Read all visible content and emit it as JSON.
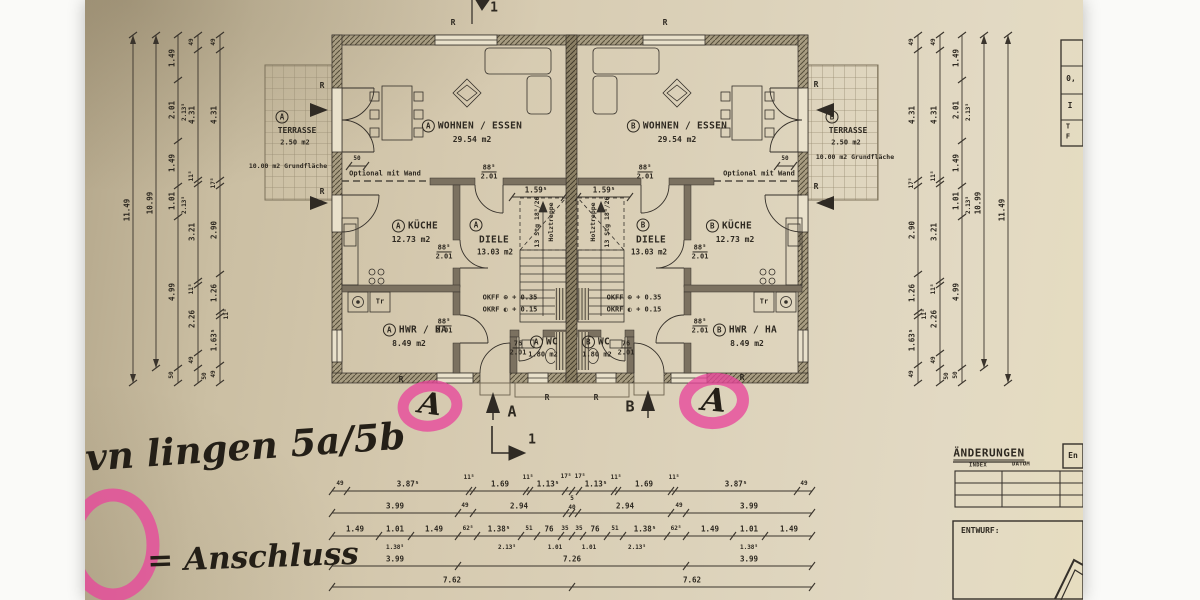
{
  "rooms": {
    "a_living": {
      "unit": "A",
      "name": "WOHNEN / ESSEN",
      "area": "29.54 m2"
    },
    "b_living": {
      "unit": "B",
      "name": "WOHNEN / ESSEN",
      "area": "29.54 m2"
    },
    "a_kitchen": {
      "unit": "A",
      "name": "KÜCHE",
      "area": "12.73 m2"
    },
    "b_kitchen": {
      "unit": "B",
      "name": "KÜCHE",
      "area": "12.73 m2"
    },
    "a_hall": {
      "unit": "A",
      "name": "DIELE",
      "area": "13.03 m2"
    },
    "b_hall": {
      "unit": "B",
      "name": "DIELE",
      "area": "13.03 m2"
    },
    "a_hwr": {
      "unit": "A",
      "name": "HWR / HA",
      "area": "8.49 m2"
    },
    "b_hwr": {
      "unit": "B",
      "name": "HWR / HA",
      "area": "8.49 m2"
    },
    "a_wc": {
      "unit": "A",
      "name": "WC",
      "area": "1.80 m2"
    },
    "b_wc": {
      "unit": "B",
      "name": "WC",
      "area": "1.80 m2"
    }
  },
  "terraces": {
    "a": {
      "unit": "A",
      "name": "TERRASSE",
      "area": "2.50 m2",
      "note": "10.00 m2 Grundfläche"
    },
    "b": {
      "unit": "B",
      "name": "TERRASSE",
      "area": "2.50 m2",
      "note": "10.00 m2 Grundfläche"
    }
  },
  "doors": {
    "w88": "88⁵",
    "w76": "76",
    "h": "2.01"
  },
  "levels": {
    "okff": "OKFF ⊕ + 0.35",
    "okrf": "OKRF ◐ + 0.15"
  },
  "stairs": {
    "dim": "1.59⁵",
    "steps": "13 Stg 18⁵/26",
    "type": "Holztreppe"
  },
  "marks": {
    "r": "R",
    "a": "A",
    "b": "B",
    "section": "1",
    "optional": "Optional mit Wand",
    "fifty": "50"
  },
  "appliances": {
    "tr": "Tr"
  },
  "handwriting": {
    "line1": "ovn lingen 5a/5b",
    "line2": "= Anschluss",
    "mark": "A"
  },
  "title_block": {
    "title": "ÄNDERUNGEN",
    "index": "INDEX",
    "datum": "DATUM",
    "box": "En",
    "entwurf": "ENTWURF:"
  },
  "side_table": {
    "r1": "0,",
    "r2": "I",
    "r3": "T",
    "r4": "F"
  },
  "dims": {
    "vchains": [
      {
        "x": 48,
        "y1": 35,
        "y2": 383,
        "a": 1,
        "ticks": [
          35,
          383
        ],
        "labels": [
          {
            "t": "11.49",
            "y": 210
          }
        ]
      },
      {
        "x": 71,
        "y1": 35,
        "y2": 368,
        "a": 1,
        "ticks": [
          35,
          368
        ],
        "labels": [
          {
            "t": "10.99",
            "y": 203
          }
        ]
      },
      {
        "x": 93,
        "y1": 35,
        "y2": 383,
        "ticks": [
          35,
          80,
          141,
          186,
          217,
          368,
          383
        ],
        "labels": [
          {
            "t": "1.49",
            "y": 58
          },
          {
            "t": "2.01",
            "y": 110
          },
          {
            "t": "2.13⁵",
            "y": 112,
            "dx": 7,
            "s": 1
          },
          {
            "t": "1.49",
            "y": 163
          },
          {
            "t": "1.01",
            "y": 201
          },
          {
            "t": "2.13⁵",
            "y": 205,
            "dx": 7,
            "s": 1
          },
          {
            "t": "4.99",
            "y": 292
          },
          {
            "t": "50",
            "y": 375,
            "s": 1
          }
        ]
      },
      {
        "x": 113,
        "y1": 35,
        "y2": 383,
        "ticks": [
          35,
          50,
          180,
          184,
          281,
          285,
          353,
          368,
          383
        ],
        "labels": [
          {
            "t": "49",
            "y": 42,
            "s": 1
          },
          {
            "t": "4.31",
            "y": 115
          },
          {
            "t": "11⁵",
            "y": 176,
            "s": 1
          },
          {
            "t": "3.21",
            "y": 232
          },
          {
            "t": "11⁵",
            "y": 289,
            "s": 1
          },
          {
            "t": "2.26",
            "y": 319
          },
          {
            "t": "49",
            "y": 360,
            "s": 1
          },
          {
            "t": "50",
            "y": 376,
            "dx": 7,
            "s": 1
          }
        ]
      },
      {
        "x": 135,
        "y1": 35,
        "y2": 383,
        "ticks": [
          35,
          50,
          180,
          186,
          274,
          312,
          316,
          365,
          383
        ],
        "labels": [
          {
            "t": "49",
            "y": 42,
            "s": 1
          },
          {
            "t": "4.31",
            "y": 115
          },
          {
            "t": "17⁵",
            "y": 183,
            "s": 1
          },
          {
            "t": "2.90",
            "y": 230
          },
          {
            "t": "1.26",
            "y": 293
          },
          {
            "t": "11⁵",
            "y": 314,
            "dx": 7,
            "s": 1
          },
          {
            "t": "1.63⁵",
            "y": 340
          },
          {
            "t": "49",
            "y": 374,
            "s": 1
          }
        ]
      },
      {
        "x": 833,
        "y1": 35,
        "y2": 383,
        "ticks": [
          35,
          50,
          180,
          186,
          274,
          312,
          316,
          365,
          383
        ],
        "labels": [
          {
            "t": "49",
            "y": 42,
            "s": 1
          },
          {
            "t": "4.31",
            "y": 115
          },
          {
            "t": "17⁵",
            "y": 183,
            "s": 1
          },
          {
            "t": "2.90",
            "y": 230
          },
          {
            "t": "1.26",
            "y": 293
          },
          {
            "t": "11⁵",
            "y": 314,
            "dx": 7,
            "s": 1
          },
          {
            "t": "1.63⁵",
            "y": 340
          },
          {
            "t": "49",
            "y": 374,
            "s": 1
          }
        ]
      },
      {
        "x": 855,
        "y1": 35,
        "y2": 383,
        "ticks": [
          35,
          50,
          180,
          184,
          281,
          285,
          353,
          368,
          383
        ],
        "labels": [
          {
            "t": "49",
            "y": 42,
            "s": 1
          },
          {
            "t": "4.31",
            "y": 115
          },
          {
            "t": "11⁵",
            "y": 176,
            "s": 1
          },
          {
            "t": "3.21",
            "y": 232
          },
          {
            "t": "11⁵",
            "y": 289,
            "s": 1
          },
          {
            "t": "2.26",
            "y": 319
          },
          {
            "t": "49",
            "y": 360,
            "s": 1
          },
          {
            "t": "50",
            "y": 376,
            "dx": 7,
            "s": 1
          }
        ]
      },
      {
        "x": 877,
        "y1": 35,
        "y2": 383,
        "ticks": [
          35,
          80,
          141,
          186,
          217,
          368,
          383
        ],
        "labels": [
          {
            "t": "1.49",
            "y": 58
          },
          {
            "t": "2.01",
            "y": 110
          },
          {
            "t": "2.13⁵",
            "y": 112,
            "dx": 7,
            "s": 1
          },
          {
            "t": "1.49",
            "y": 163
          },
          {
            "t": "1.01",
            "y": 201
          },
          {
            "t": "2.13⁵",
            "y": 205,
            "dx": 7,
            "s": 1
          },
          {
            "t": "4.99",
            "y": 292
          },
          {
            "t": "50",
            "y": 375,
            "s": 1
          }
        ]
      },
      {
        "x": 899,
        "y1": 35,
        "y2": 368,
        "a": 1,
        "ticks": [
          35,
          368
        ],
        "labels": [
          {
            "t": "10.99",
            "y": 203
          }
        ]
      },
      {
        "x": 923,
        "y1": 35,
        "y2": 383,
        "a": 1,
        "ticks": [
          35,
          383
        ],
        "labels": [
          {
            "t": "11.49",
            "y": 210
          }
        ]
      }
    ],
    "hchains": [
      {
        "y": 491,
        "x1": 247,
        "x2": 727,
        "ticks": [
          247,
          262,
          384,
          388,
          441,
          445,
          480,
          487,
          494,
          529,
          533,
          586,
          590,
          712,
          727
        ],
        "labels": [
          {
            "t": "49",
            "x": 255,
            "s": 1
          },
          {
            "t": "3.87⁵",
            "x": 323
          },
          {
            "t": "11⁵",
            "x": 384,
            "s": 1,
            "dy": -13
          },
          {
            "t": "1.69",
            "x": 415
          },
          {
            "t": "11⁵",
            "x": 443,
            "s": 1,
            "dy": -13
          },
          {
            "t": "1.13⁵",
            "x": 463
          },
          {
            "t": "17⁵",
            "x": 481,
            "s": 1,
            "dy": -14
          },
          {
            "t": "17⁵",
            "x": 495,
            "s": 1,
            "dy": -14
          },
          {
            "t": "1.13⁵",
            "x": 511
          },
          {
            "t": "11⁵",
            "x": 531,
            "s": 1,
            "dy": -13
          },
          {
            "t": "1.69",
            "x": 559
          },
          {
            "t": "11⁵",
            "x": 589,
            "s": 1,
            "dy": -13
          },
          {
            "t": "3.87⁵",
            "x": 651
          },
          {
            "t": "49",
            "x": 719,
            "s": 1
          }
        ]
      },
      {
        "y": 513,
        "x1": 247,
        "x2": 727,
        "ticks": [
          247,
          373,
          388,
          481,
          487,
          493,
          586,
          601,
          727
        ],
        "labels": [
          {
            "t": "3.99",
            "x": 310
          },
          {
            "t": "49",
            "x": 380,
            "s": 1
          },
          {
            "t": "2.94",
            "x": 434
          },
          {
            "t": "5",
            "x": 487,
            "s": 1,
            "dy": -14
          },
          {
            "t": "40",
            "x": 487,
            "s": 1,
            "dy": -5
          },
          {
            "t": "2.94",
            "x": 540
          },
          {
            "t": "49",
            "x": 594,
            "s": 1
          },
          {
            "t": "3.99",
            "x": 664
          }
        ]
      },
      {
        "y": 536,
        "x1": 247,
        "x2": 727,
        "ticks": [
          247,
          294,
          326,
          373,
          392,
          436,
          452,
          476,
          487,
          498,
          522,
          538,
          582,
          601,
          648,
          680,
          727
        ],
        "labels": [
          {
            "t": "1.49",
            "x": 270
          },
          {
            "t": "1.01",
            "x": 310
          },
          {
            "t": "1.49",
            "x": 349
          },
          {
            "t": "62⁵",
            "x": 383,
            "s": 1
          },
          {
            "t": "1.38⁵",
            "x": 414
          },
          {
            "t": "51",
            "x": 444,
            "s": 1
          },
          {
            "t": "76",
            "x": 464
          },
          {
            "t": "35",
            "x": 480,
            "s": 1
          },
          {
            "t": "35",
            "x": 494,
            "s": 1
          },
          {
            "t": "76",
            "x": 510
          },
          {
            "t": "51",
            "x": 530,
            "s": 1
          },
          {
            "t": "1.38⁵",
            "x": 560
          },
          {
            "t": "62⁵",
            "x": 591,
            "s": 1
          },
          {
            "t": "1.49",
            "x": 625
          },
          {
            "t": "1.01",
            "x": 664
          },
          {
            "t": "1.49",
            "x": 704
          }
        ]
      },
      {
        "y": 547,
        "x1": 0,
        "x2": 0,
        "ticks": [],
        "labels": [
          {
            "t": "1.38⁵",
            "x": 310,
            "s": 1,
            "dy": 1
          },
          {
            "t": "2.13⁵",
            "x": 422,
            "s": 1,
            "dy": 1
          },
          {
            "t": "1.01",
            "x": 470,
            "s": 1,
            "dy": 1
          },
          {
            "t": "1.01",
            "x": 504,
            "s": 1,
            "dy": 1
          },
          {
            "t": "2.13⁵",
            "x": 552,
            "s": 1,
            "dy": 1
          },
          {
            "t": "1.38⁵",
            "x": 664,
            "s": 1,
            "dy": 1
          }
        ]
      },
      {
        "y": 566,
        "x1": 247,
        "x2": 727,
        "ticks": [
          247,
          373,
          601,
          727
        ],
        "labels": [
          {
            "t": "3.99",
            "x": 310
          },
          {
            "t": "7.26",
            "x": 487
          },
          {
            "t": "3.99",
            "x": 664
          }
        ]
      },
      {
        "y": 587,
        "x1": 247,
        "x2": 727,
        "ticks": [
          247,
          487,
          727
        ],
        "labels": [
          {
            "t": "7.62",
            "x": 367
          },
          {
            "t": "7.62",
            "x": 607
          }
        ]
      },
      {
        "y": 166,
        "x1": 264,
        "x2": 281,
        "ticks": [
          264,
          281
        ],
        "labels": [
          {
            "t": "50",
            "x": 272,
            "s": 1
          }
        ]
      },
      {
        "y": 166,
        "x1": 692,
        "x2": 709,
        "ticks": [
          692,
          709
        ],
        "labels": [
          {
            "t": "50",
            "x": 700,
            "s": 1
          }
        ]
      },
      {
        "y": 197,
        "x1": 427,
        "x2": 479,
        "ticks": [
          427,
          479
        ],
        "labels": [
          {
            "t": "1.59⁵",
            "x": 451
          }
        ]
      },
      {
        "y": 197,
        "x1": 493,
        "x2": 545,
        "ticks": [
          493,
          545
        ],
        "labels": [
          {
            "t": "1.59⁵",
            "x": 519
          }
        ]
      }
    ]
  }
}
